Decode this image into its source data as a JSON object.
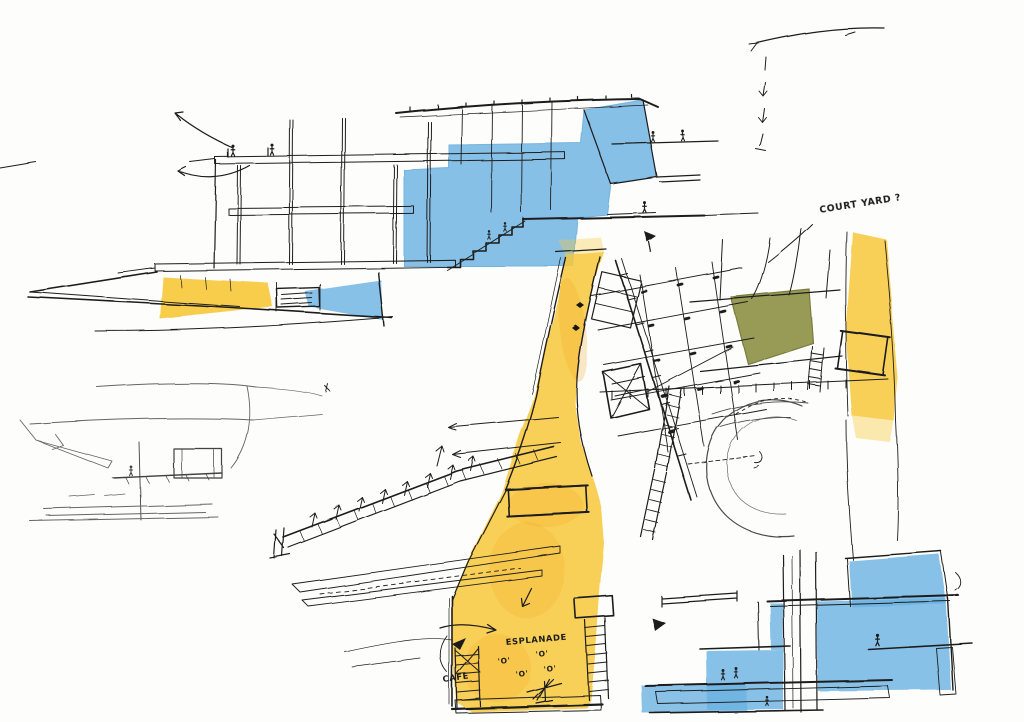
{
  "palette": {
    "paper": "#fdfdfb",
    "ink": "#1f1f1f",
    "blue_pencil": "#6db3e2",
    "blue_pencil_edge": "#55a4d8",
    "yellow_pencil": "#f7c838",
    "orange_pencil": "#f0a21c",
    "olive_pencil": "#8f9347",
    "olive_pencil_edge": "#6f722f"
  },
  "annotations": {
    "courtyard": "COURT YARD ?",
    "esplanade": "ESPLANADE",
    "cafe": "CAFE",
    "table_marks": [
      {
        "text": "'O'"
      },
      {
        "text": "'O'"
      },
      {
        "text": "'O'"
      },
      {
        "text": "'O'"
      }
    ]
  }
}
